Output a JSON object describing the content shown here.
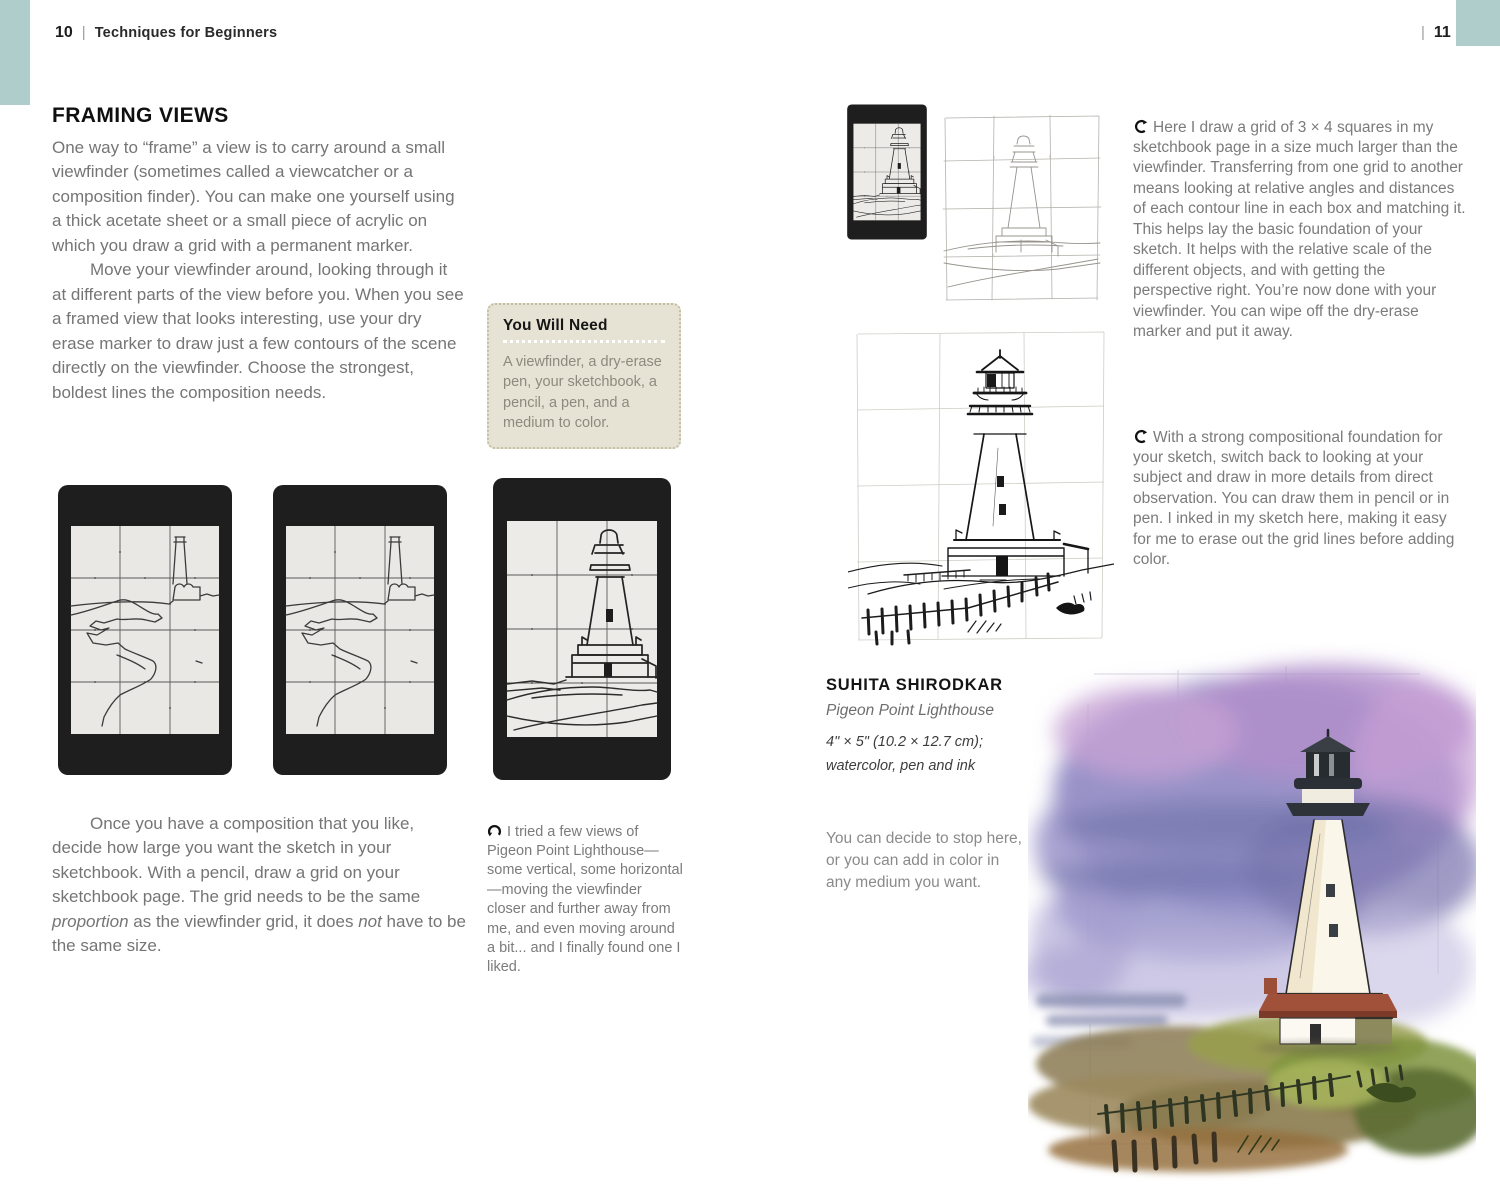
{
  "header": {
    "left": {
      "number": "10",
      "divider": "|",
      "title": "Techniques for Beginners"
    },
    "right": {
      "divider": "|",
      "number": "11"
    }
  },
  "left_page": {
    "heading": "FRAMING VIEWS",
    "para1": "One way to “frame” a view is to carry around a small viewfinder (sometimes called a viewcatcher or a composition finder). You can make one yourself using a thick acetate sheet or a small piece of acrylic on which you draw a grid with a permanent marker.",
    "para2": "Move your viewfinder around, looking through it at different parts of the view before you. When you see a framed view that looks interesting, use your dry erase marker to draw just a few contours of the scene directly on the viewfinder. Choose the strongest, boldest lines the composition needs.",
    "you_will_need": {
      "title": "You Will Need",
      "text": "A viewfinder, a dry-erase pen, your sketchbook, a pencil, a pen, and a medium to color."
    },
    "para3": {
      "pre": "Once you have a composition that you like, decide how large you want the sketch in your sketchbook. With a pencil, draw a grid on your sketchbook page. The grid needs to be the same ",
      "italic1": "proportion",
      "mid": " as the viewfinder grid, it does ",
      "italic2": "not",
      "post": " have to be the same size."
    },
    "caption": "I tried a few views of Pigeon Point Lighthouse—some vertical, some horizontal—moving the viewfinder closer and further away from me, and even moving around a bit... and I finally found one I liked."
  },
  "right_page": {
    "para1": "Here I draw a grid of 3 × 4 squares in my sketchbook page in a size much larger than the viewfinder. Transferring from one grid to another means looking at relative angles and distances of each contour line in each box and matching it. This helps lay the basic foundation of your sketch. It helps with the relative scale of the different objects, and with getting the perspective right. You’re now done with your viewfinder. You can wipe off the dry-erase marker and put it away.",
    "para2": "With a strong compositional foundation for your sketch, switch back to looking at your subject and draw in more details from direct observation. You can draw them in pencil or in pen. I inked in my sketch here, making it easy for me to erase out the grid lines before adding color.",
    "credit": {
      "name": "SUHITA SHIRODKAR",
      "work": "Pigeon Point Lighthouse",
      "size": "4\" × 5\" (10.2 × 12.7 cm);",
      "medium": "watercolor, pen and ink"
    },
    "closing": "You can decide to stop here, or you can add in color in any medium you want."
  },
  "icons": {
    "caption_left_arrow": "curved-arrow-up-icon",
    "caption_right_arrow": "curved-arrow-left-icon"
  },
  "artwork": {
    "viewfinder_wide_1": "black viewfinder with grid, lighthouse coastline contour sketch",
    "viewfinder_wide_2": "black viewfinder with grid, lighthouse coastline contour sketch",
    "viewfinder_close": "black viewfinder with grid, close-up lighthouse contour sketch",
    "viewfinder_thumb": "small black viewfinder with lighthouse sketch",
    "pencil_grid_sketch": "pencil grid sketch of lighthouse on sketchbook page",
    "ink_sketch": "pen and ink sketch of Pigeon Point Lighthouse",
    "watercolor": "watercolor of Pigeon Point Lighthouse with purple sky"
  },
  "colors": {
    "accent_teal": "#aecdcb",
    "need_box_bg": "#e6e3d4",
    "body_gray": "#757575"
  }
}
